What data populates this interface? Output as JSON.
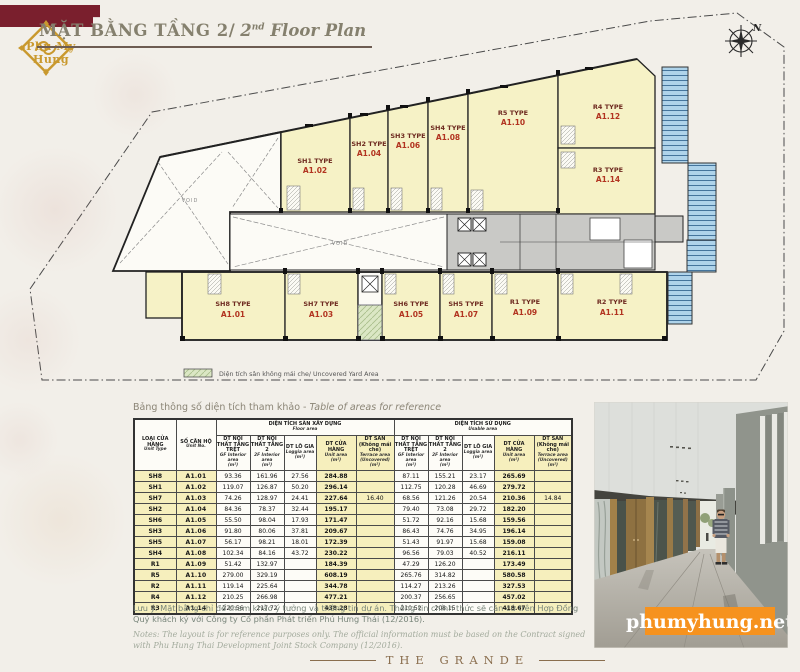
{
  "logo": {
    "name": "Phu My Hung"
  },
  "header": {
    "title_vn": "MẶT BẰNG TẦNG 2/",
    "title_en_num": "2",
    "title_en_sup": "nd",
    "title_en_rest": " Floor Plan"
  },
  "plan": {
    "compass": "N",
    "void": "VOID",
    "legend": "Diện tích sân không mái che/ Uncovered Yard Area",
    "units": [
      {
        "type": "SH1 TYPE",
        "code": "A1.02"
      },
      {
        "type": "SH2 TYPE",
        "code": "A1.04"
      },
      {
        "type": "SH3 TYPE",
        "code": "A1.06"
      },
      {
        "type": "SH4 TYPE",
        "code": "A1.08"
      },
      {
        "type": "R5 TYPE",
        "code": "A1.10"
      },
      {
        "type": "R4 TYPE",
        "code": "A1.12"
      },
      {
        "type": "R3 TYPE",
        "code": "A1.14"
      },
      {
        "type": "SH8 TYPE",
        "code": "A1.01"
      },
      {
        "type": "SH7 TYPE",
        "code": "A1.03"
      },
      {
        "type": "SH6 TYPE",
        "code": "A1.05"
      },
      {
        "type": "SH5 TYPE",
        "code": "A1.07"
      },
      {
        "type": "R1 TYPE",
        "code": "A1.09"
      },
      {
        "type": "R2 TYPE",
        "code": "A1.11"
      }
    ]
  },
  "table": {
    "title_vn": "Bảng thông số diện tích tham khảo - ",
    "title_en": "Table of areas for reference",
    "header": {
      "col1_vn": "LOẠI CỬA HÀNG",
      "col1_en": "Unit Type",
      "col2_vn": "SỐ CĂN HỘ",
      "col2_en": "Unit No.",
      "group1_vn": "DIỆN TÍCH SÀN XÂY DỰNG",
      "group1_en": "Floor area",
      "group2_vn": "DIỆN TÍCH SỬ DỤNG",
      "group2_en": "Usable area",
      "sub": [
        {
          "vn": "DT NỘI THẤT TẦNG TRỆT",
          "en": "GF Interior area",
          "unit": "(m²)",
          "hl": false
        },
        {
          "vn": "DT NỘI THẤT TẦNG 2",
          "en": "2F Interior area",
          "unit": "(m²)",
          "hl": false
        },
        {
          "vn": "DT LÔ GIA",
          "en": "Loggia area",
          "unit": "(m²)",
          "hl": false
        },
        {
          "vn": "DT CỬA HÀNG",
          "en": "Unit area",
          "unit": "(m²)",
          "hl": true
        },
        {
          "vn": "DT SÂN (Không mái che)",
          "en": "Terrace area (Uncovered)",
          "unit": "(m²)",
          "hl": true
        }
      ]
    },
    "rows": [
      [
        "SH8",
        "A1.01",
        "93.36",
        "161.96",
        "27.56",
        "284.88",
        "",
        "87.11",
        "155.21",
        "23.17",
        "265.69",
        ""
      ],
      [
        "SH1",
        "A1.02",
        "119.07",
        "126.87",
        "50.20",
        "296.14",
        "",
        "112.75",
        "120.28",
        "46.69",
        "279.72",
        ""
      ],
      [
        "SH7",
        "A1.03",
        "74.26",
        "128.97",
        "24.41",
        "227.64",
        "16.40",
        "68.56",
        "121.26",
        "20.54",
        "210.36",
        "14.84"
      ],
      [
        "SH2",
        "A1.04",
        "84.36",
        "78.37",
        "32.44",
        "195.17",
        "",
        "79.40",
        "73.08",
        "29.72",
        "182.20",
        ""
      ],
      [
        "SH6",
        "A1.05",
        "55.50",
        "98.04",
        "17.93",
        "171.47",
        "",
        "51.72",
        "92.16",
        "15.68",
        "159.56",
        ""
      ],
      [
        "SH3",
        "A1.06",
        "91.80",
        "80.06",
        "37.81",
        "209.67",
        "",
        "86.43",
        "74.76",
        "34.95",
        "196.14",
        ""
      ],
      [
        "SH5",
        "A1.07",
        "56.17",
        "98.21",
        "18.01",
        "172.39",
        "",
        "51.43",
        "91.97",
        "15.68",
        "159.08",
        ""
      ],
      [
        "SH4",
        "A1.08",
        "102.34",
        "84.16",
        "43.72",
        "230.22",
        "",
        "96.56",
        "79.03",
        "40.52",
        "216.11",
        ""
      ],
      [
        "R1",
        "A1.09",
        "51.42",
        "132.97",
        "",
        "184.39",
        "",
        "47.29",
        "126.20",
        "",
        "173.49",
        ""
      ],
      [
        "R5",
        "A1.10",
        "279.00",
        "329.19",
        "",
        "608.19",
        "",
        "265.76",
        "314.82",
        "",
        "580.58",
        ""
      ],
      [
        "R2",
        "A1.11",
        "119.14",
        "225.64",
        "",
        "344.78",
        "",
        "114.27",
        "213.26",
        "",
        "327.53",
        ""
      ],
      [
        "R4",
        "A1.12",
        "210.25",
        "266.98",
        "",
        "477.21",
        "",
        "200.37",
        "256.65",
        "",
        "457.02",
        ""
      ],
      [
        "R3",
        "A1.14",
        "220.56",
        "217.72",
        "",
        "438.28",
        "",
        "210.52",
        "208.15",
        "",
        "418.67",
        ""
      ]
    ]
  },
  "notes": {
    "vn": "Lưu ý: Mặt bằng chỉ để tham khảo ý tưởng và thông tin dự án. Thông tin chính thức sẽ căn cứ trên Hợp Đồng Quý khách ký với Công ty Cổ phần Phát triển Phú Hưng Thái (12/2016).",
    "en": "Notes: The layout is for reference purposes only. The official information must be based on the Contract signed with Phu Hung Thai Development Joint Stock Company (12/2016)."
  },
  "footer": {
    "brand": "THE GRANDE"
  },
  "photo": {
    "watermark": "phumyhung.net"
  },
  "colors": {
    "accent_orange": "#f6921e",
    "unit_fill": "#f6f2c6",
    "label_red": "#b23420",
    "maroon": "#7a1f2d",
    "gold": "#c9992e",
    "stair_blue": "#aed3ea"
  }
}
